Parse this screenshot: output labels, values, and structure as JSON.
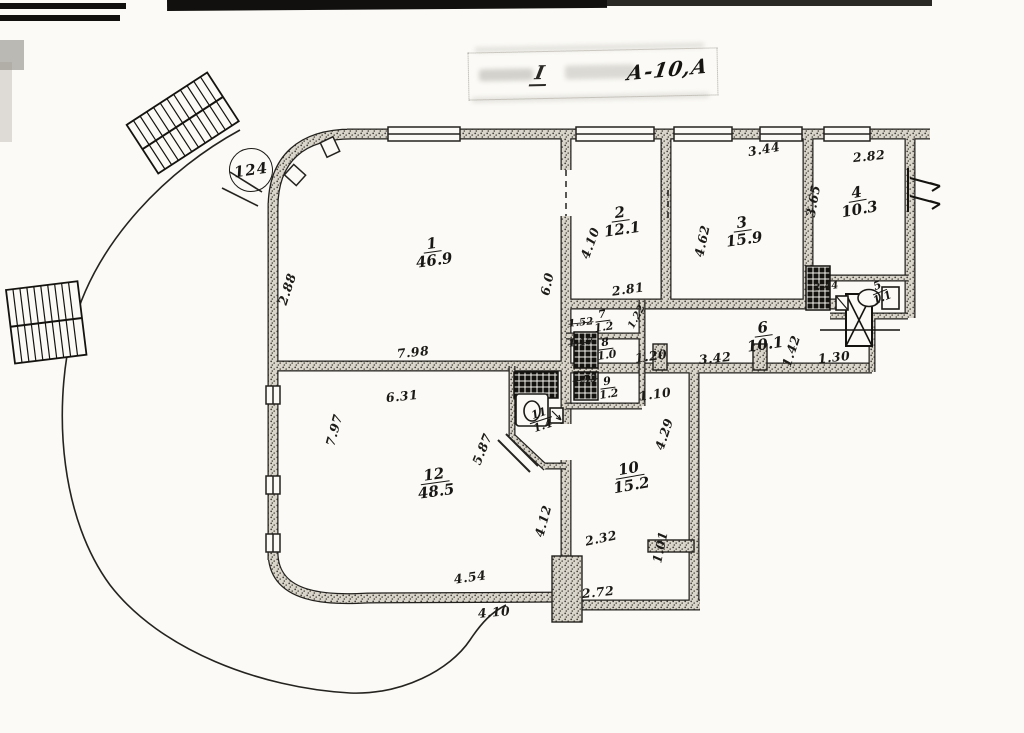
{
  "stamp": {
    "prefix": "I",
    "code": "А-10,А"
  },
  "site_number": "124",
  "rooms": [
    {
      "n": "1",
      "area": "46.9",
      "x": 433,
      "y": 252,
      "rot": -8,
      "size": "md"
    },
    {
      "n": "2",
      "area": "12.1",
      "x": 621,
      "y": 221,
      "rot": -8,
      "size": "md"
    },
    {
      "n": "3",
      "area": "15.9",
      "x": 743,
      "y": 231,
      "rot": -8,
      "size": "md"
    },
    {
      "n": "4",
      "area": "10.3",
      "x": 858,
      "y": 201,
      "rot": -10,
      "size": "md"
    },
    {
      "n": "5",
      "area": "1.1",
      "x": 880,
      "y": 292,
      "rot": -22,
      "size": "sm"
    },
    {
      "n": "6",
      "area": "10.1",
      "x": 764,
      "y": 336,
      "rot": -8,
      "size": "md"
    },
    {
      "n": "7",
      "area": "1.2",
      "x": 603,
      "y": 321,
      "rot": -8,
      "size": "sm"
    },
    {
      "n": "8",
      "area": "1.0",
      "x": 606,
      "y": 349,
      "rot": -8,
      "size": "sm"
    },
    {
      "n": "9",
      "area": "1.2",
      "x": 608,
      "y": 388,
      "rot": -8,
      "size": "sm"
    },
    {
      "n": "10",
      "area": "15.2",
      "x": 630,
      "y": 477,
      "rot": -10,
      "size": "md"
    },
    {
      "n": "11",
      "area": "1.4",
      "x": 541,
      "y": 420,
      "rot": -18,
      "size": "sm"
    },
    {
      "n": "12",
      "area": "48.5",
      "x": 435,
      "y": 483,
      "rot": -8,
      "size": "md"
    }
  ],
  "dims": [
    {
      "t": "2.88",
      "x": 287,
      "y": 289,
      "rot": -72
    },
    {
      "t": "7.98",
      "x": 413,
      "y": 352,
      "rot": -6
    },
    {
      "t": "6.31",
      "x": 402,
      "y": 396,
      "rot": -6
    },
    {
      "t": "7.97",
      "x": 334,
      "y": 430,
      "rot": -75
    },
    {
      "t": "5.87",
      "x": 482,
      "y": 449,
      "rot": -68
    },
    {
      "t": "6.0",
      "x": 547,
      "y": 284,
      "rot": -78
    },
    {
      "t": "4.10",
      "x": 590,
      "y": 243,
      "rot": -70
    },
    {
      "t": "2.81",
      "x": 628,
      "y": 289,
      "rot": -8
    },
    {
      "t": "3.44",
      "x": 764,
      "y": 149,
      "rot": -10
    },
    {
      "t": "2.82",
      "x": 869,
      "y": 156,
      "rot": -6
    },
    {
      "t": "3.65",
      "x": 813,
      "y": 201,
      "rot": -80
    },
    {
      "t": "4.62",
      "x": 702,
      "y": 241,
      "rot": -78
    },
    {
      "t": "2.44",
      "x": 826,
      "y": 287,
      "rot": -6,
      "sm": true
    },
    {
      "t": "1.22",
      "x": 637,
      "y": 317,
      "rot": -62,
      "sm": true
    },
    {
      "t": "1.52",
      "x": 581,
      "y": 323,
      "rot": -6,
      "sm": true,
      "struck": true
    },
    {
      "t": "1.17",
      "x": 581,
      "y": 343,
      "rot": -6,
      "sm": true,
      "struck": true
    },
    {
      "t": "1.53",
      "x": 585,
      "y": 380,
      "rot": -6,
      "sm": true,
      "struck": true
    },
    {
      "t": "1.20",
      "x": 651,
      "y": 356,
      "rot": -8
    },
    {
      "t": "3.42",
      "x": 715,
      "y": 358,
      "rot": -6
    },
    {
      "t": "1.42",
      "x": 791,
      "y": 351,
      "rot": -72
    },
    {
      "t": "1.30",
      "x": 834,
      "y": 357,
      "rot": -6
    },
    {
      "t": "1.10",
      "x": 655,
      "y": 394,
      "rot": -8
    },
    {
      "t": "4.29",
      "x": 664,
      "y": 434,
      "rot": -72
    },
    {
      "t": "4.12",
      "x": 543,
      "y": 521,
      "rot": -75
    },
    {
      "t": "2.32",
      "x": 601,
      "y": 538,
      "rot": -12
    },
    {
      "t": "1.01",
      "x": 660,
      "y": 547,
      "rot": -78
    },
    {
      "t": "2.72",
      "x": 598,
      "y": 592,
      "rot": -6
    },
    {
      "t": "4.54",
      "x": 470,
      "y": 577,
      "rot": -8
    },
    {
      "t": "4.10",
      "x": 494,
      "y": 612,
      "rot": -5
    }
  ]
}
